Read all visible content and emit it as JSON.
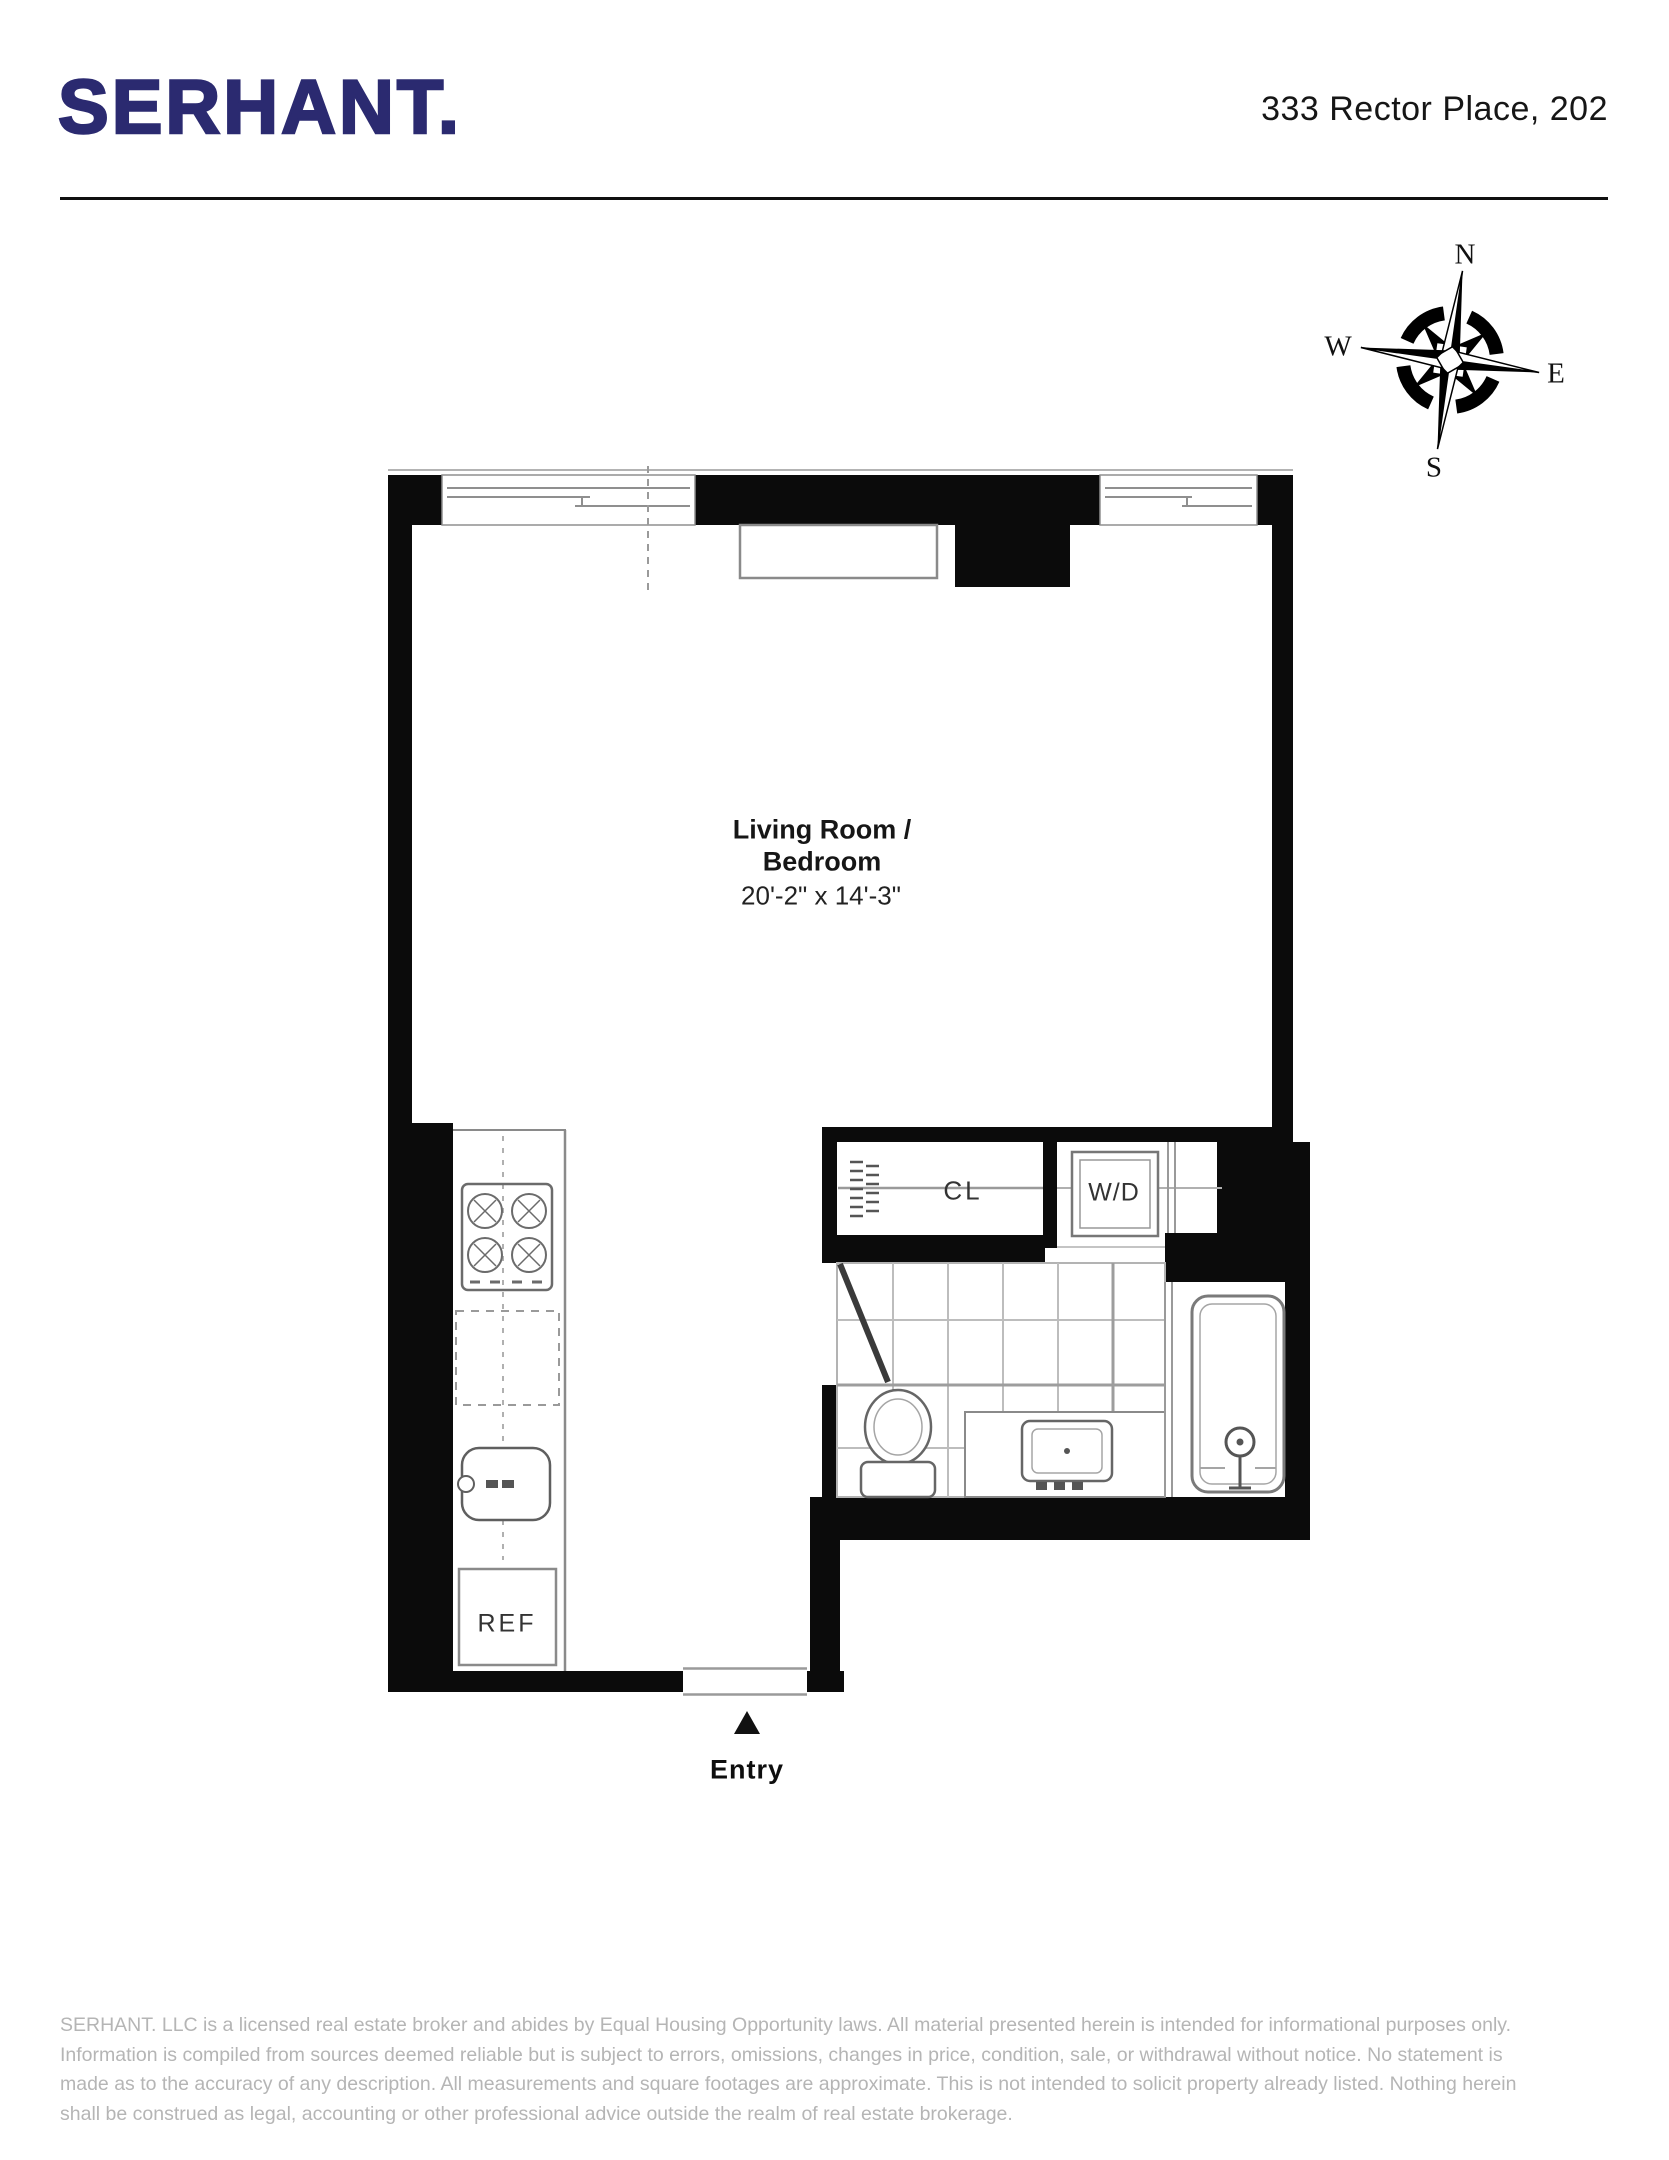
{
  "header": {
    "logo": "SERHANT.",
    "address": "333 Rector Place, 202"
  },
  "compass": {
    "n": "N",
    "e": "E",
    "s": "S",
    "w": "W"
  },
  "rooms": {
    "living_room": {
      "name_line1": "Living Room /",
      "name_line2": "Bedroom",
      "dimensions": "20'-2\" x 14'-3\""
    },
    "closet_label": "CL",
    "washer_dryer_label": "W/D",
    "refrigerator_label": "REF",
    "entry_label": "Entry"
  },
  "footer": {
    "disclaimer": "SERHANT. LLC is a licensed real estate broker and abides by Equal Housing Opportunity laws. All material presented herein is intended for informational purposes only. Information is compiled from sources deemed reliable but is subject to errors, omissions, changes in price, condition, sale, or withdrawal without notice. No statement is made as to the accuracy of any description. All measurements and square footages are approximate. This is not intended to solicit property already listed. Nothing herein shall be construed as legal, accounting or other professional advice outside the realm of real estate brokerage."
  },
  "colors": {
    "brand_navy": "#2b2a70",
    "wall_black": "#0b0b0b",
    "fixture_gray": "#6b6b6b",
    "tile_gray": "#b9b9b9",
    "disclaimer_gray": "#b5b5b5"
  }
}
